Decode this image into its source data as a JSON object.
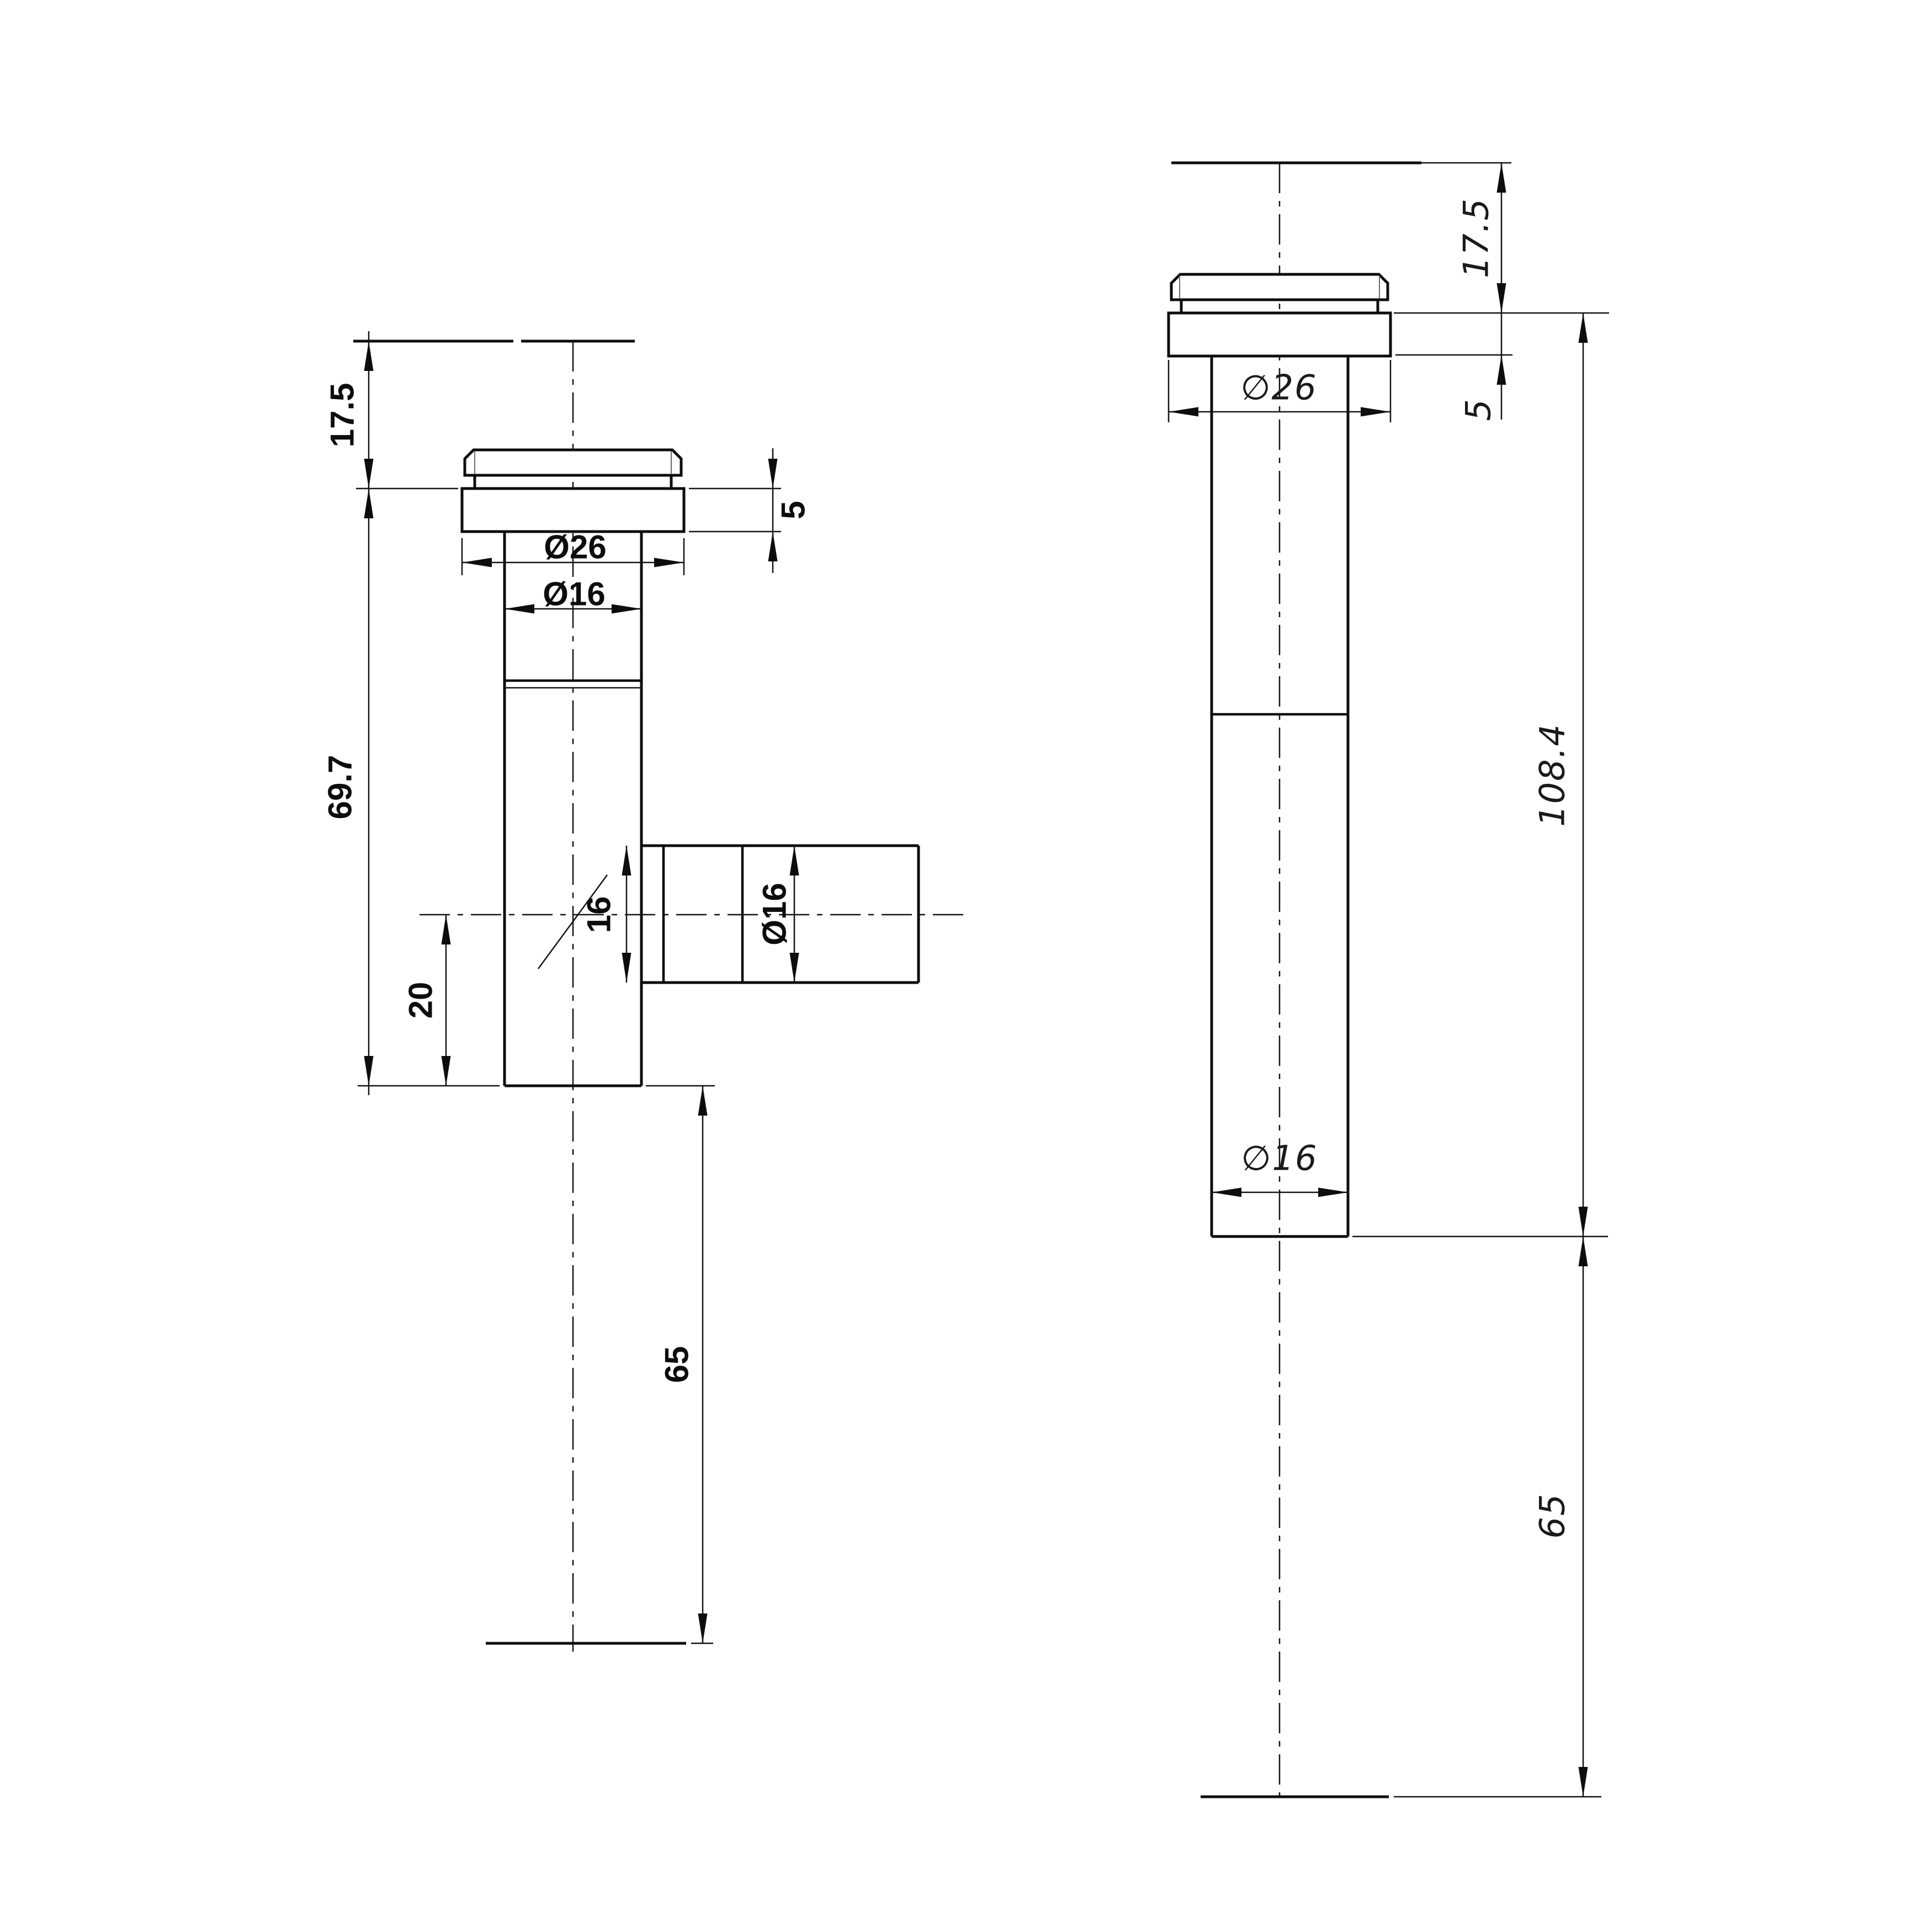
{
  "drawing": {
    "kind": "technical-dimension-drawing",
    "background": "#ffffff",
    "line_color": "#0d0d0d",
    "views": {
      "front": {
        "title": "front-view-tee-fitting",
        "labels": {
          "top_clearance": "17.5",
          "flange_thickness": "5",
          "flange_diameter": "Ø26",
          "pipe_diameter": "Ø16",
          "body_length": "69.7",
          "branch_offset": "20",
          "tail_length": "65",
          "branch_bore": "16",
          "branch_diameter": "Ø16"
        }
      },
      "side": {
        "title": "side-view-tee-fitting",
        "labels": {
          "top_clearance": "17.5",
          "flange_thickness": "5",
          "flange_diameter": "∅26",
          "pipe_diameter": "∅16",
          "overall_length": "108.4",
          "tail_length": "65"
        }
      }
    }
  }
}
